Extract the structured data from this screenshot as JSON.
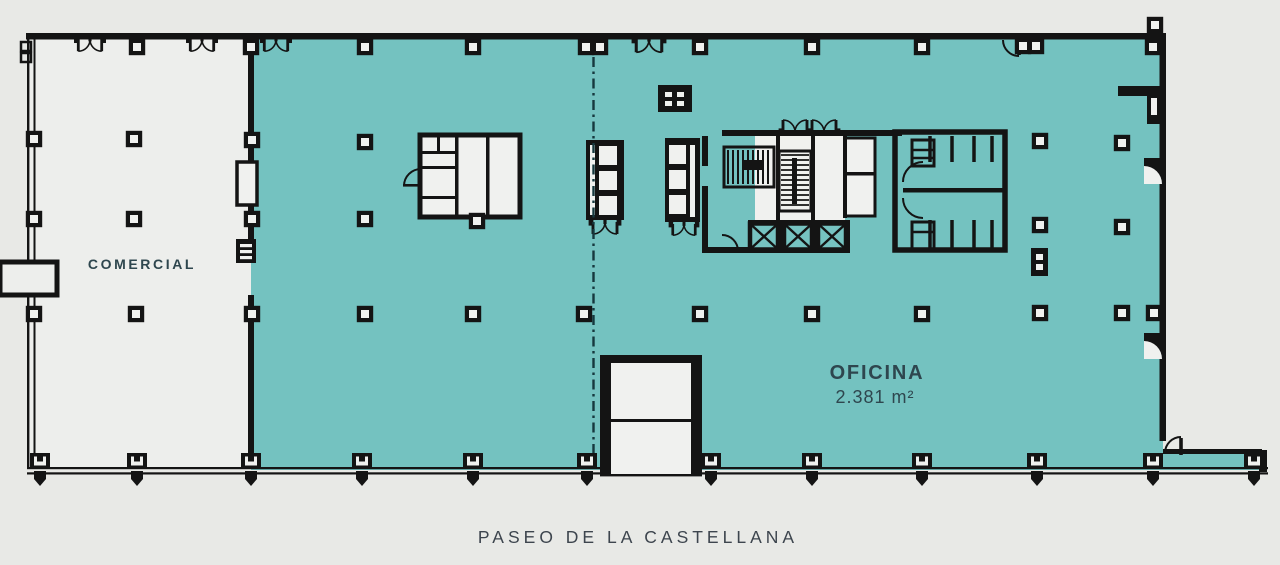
{
  "labels": {
    "commercial": "COMERCIAL",
    "office": "OFICINA",
    "office_area": "2.381 m²",
    "street": "PASEO DE LA CASTELLANA"
  },
  "colors": {
    "background": "#e8e9e6",
    "office_fill": "#74c2c0",
    "commercial_fill": "#edeeec",
    "room_fill": "#f0f1ef",
    "wall": "#141414",
    "room_label": "#2e464e",
    "street_label": "#3d454e"
  }
}
